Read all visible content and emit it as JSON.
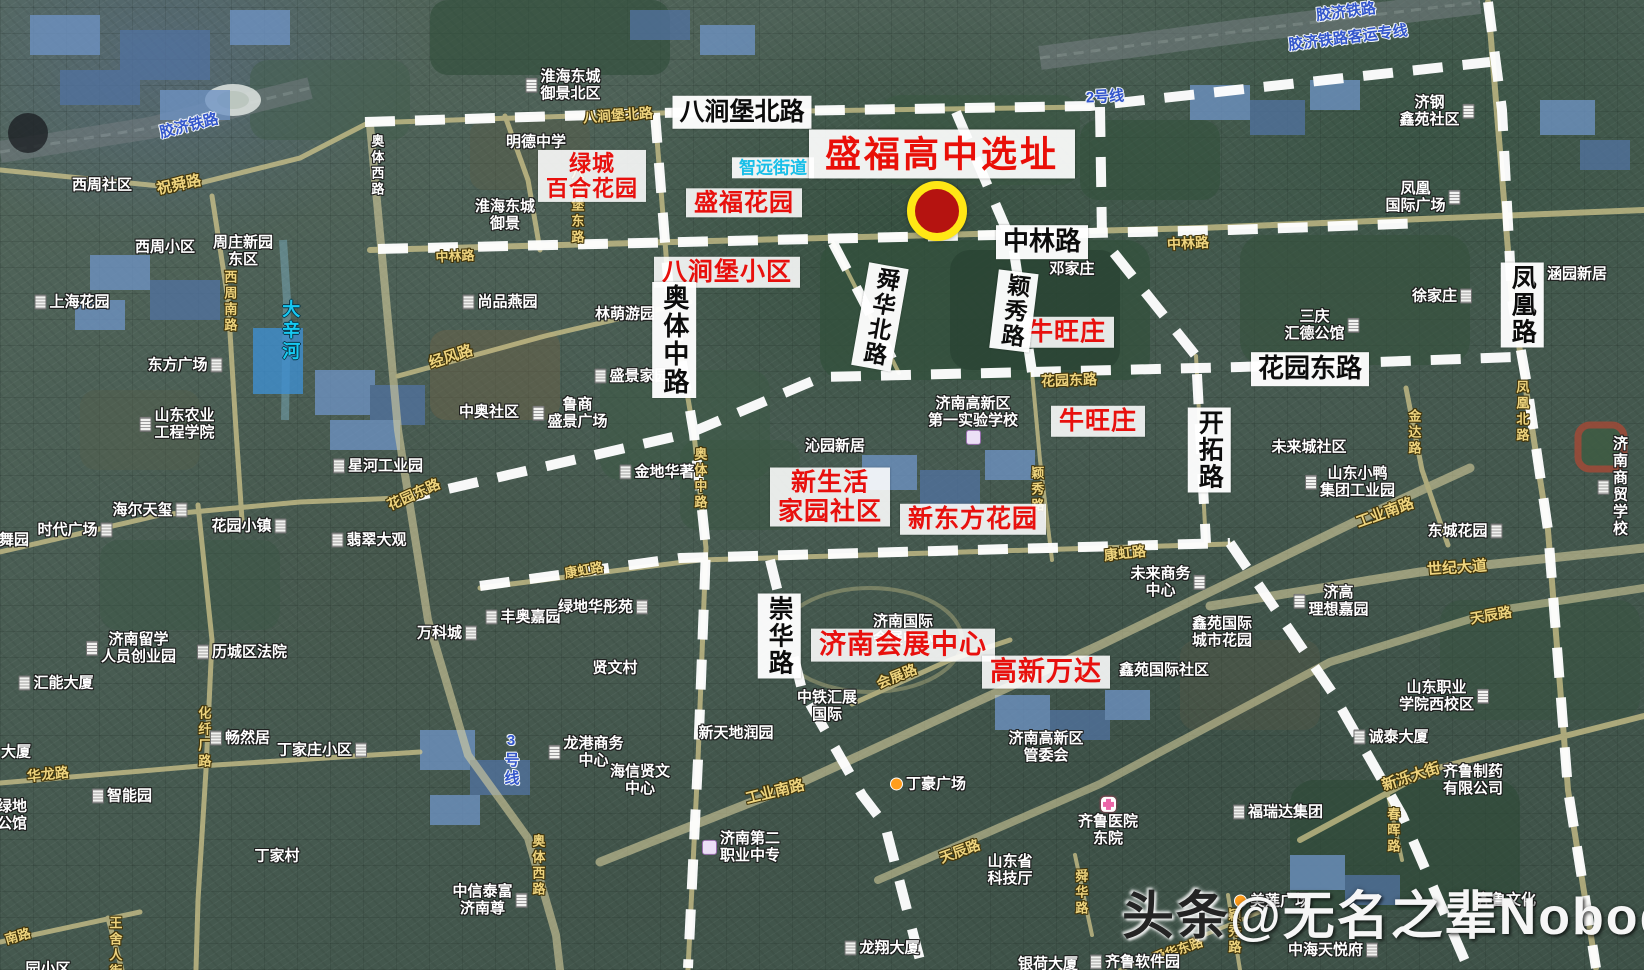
{
  "map": {
    "type": "satellite-annotated",
    "subject": "盛福高中选址",
    "city_area": "济南高新区 / 历城区",
    "accent_red": "#e8100d",
    "road_dash_color": "#ffffff",
    "road_fill_color": "#d7cb8e"
  },
  "marker": {
    "x": 937,
    "y": 211,
    "core_diameter": 44,
    "ring_width": 8,
    "ring_color": "#ffe715",
    "fill_color": "#b51310"
  },
  "watermark": {
    "x": 1122,
    "y": 874,
    "brand": "头条",
    "handle": "@无名之辈Nobody"
  },
  "labels": [
    {
      "t": "盛福高中选址",
      "x": 942,
      "y": 154,
      "k": "title",
      "name": "site-title"
    },
    {
      "t": "绿城\n百合花园",
      "x": 592,
      "y": 176,
      "k": "red",
      "fs": 22
    },
    {
      "t": "盛福花园",
      "x": 744,
      "y": 203,
      "k": "red",
      "fs": 24
    },
    {
      "t": "八涧堡小区",
      "x": 727,
      "y": 272,
      "k": "red",
      "fs": 25
    },
    {
      "t": "牛旺庄",
      "x": 1067,
      "y": 332,
      "k": "red",
      "fs": 25
    },
    {
      "t": "牛旺庄",
      "x": 1098,
      "y": 421,
      "k": "red",
      "fs": 25
    },
    {
      "t": "新生活\n家园社区",
      "x": 830,
      "y": 497,
      "k": "red",
      "fs": 25
    },
    {
      "t": "新东方花园",
      "x": 973,
      "y": 519,
      "k": "red",
      "fs": 25
    },
    {
      "t": "济南会展中心",
      "x": 903,
      "y": 645,
      "k": "red",
      "fs": 27
    },
    {
      "t": "高新万达",
      "x": 1046,
      "y": 672,
      "k": "red",
      "fs": 27
    },
    {
      "t": "八涧堡北路",
      "x": 742,
      "y": 112,
      "k": "roadbig",
      "fs": 25
    },
    {
      "t": "中林路",
      "x": 1042,
      "y": 242,
      "k": "roadbig",
      "fs": 26
    },
    {
      "t": "花园东路",
      "x": 1310,
      "y": 369,
      "k": "roadbig",
      "fs": 26
    },
    {
      "t": "奥体中路",
      "x": 674,
      "y": 340,
      "k": "roadbig",
      "v": 1,
      "fs": 26
    },
    {
      "t": "舜华北路",
      "x": 880,
      "y": 317,
      "k": "roadbig",
      "v": 1,
      "fs": 23,
      "r": 10
    },
    {
      "t": "颖秀路",
      "x": 1014,
      "y": 311,
      "k": "roadbig",
      "v": 1,
      "fs": 23,
      "r": 7
    },
    {
      "t": "开拓路",
      "x": 1209,
      "y": 450,
      "k": "roadbig",
      "v": 1,
      "fs": 25
    },
    {
      "t": "崇华路",
      "x": 779,
      "y": 636,
      "k": "roadbig",
      "v": 1,
      "fs": 25
    },
    {
      "t": "凤凰路",
      "x": 1522,
      "y": 305,
      "k": "roadbig",
      "v": 1,
      "fs": 25
    },
    {
      "t": "胶济铁路",
      "x": 189,
      "y": 126,
      "k": "rail",
      "r": -14
    },
    {
      "t": "胶济铁路",
      "x": 1346,
      "y": 12,
      "k": "rail",
      "r": -7
    },
    {
      "t": "胶济铁路客运专线",
      "x": 1348,
      "y": 38,
      "k": "rail",
      "r": -7
    },
    {
      "t": "2号线",
      "x": 1105,
      "y": 97,
      "k": "rail",
      "r": -3
    },
    {
      "t": "3号线",
      "x": 511,
      "y": 760,
      "k": "rail",
      "v": 1
    },
    {
      "t": "大辛河",
      "x": 290,
      "y": 331,
      "k": "river",
      "v": 1
    },
    {
      "t": "智远街道",
      "x": 773,
      "y": 168,
      "k": "cyanpanel"
    },
    {
      "t": "祝舜路",
      "x": 179,
      "y": 185,
      "k": "ry",
      "r": -12,
      "fs": 15
    },
    {
      "t": "八涧堡北路",
      "x": 618,
      "y": 116,
      "k": "ry",
      "r": -4,
      "fs": 14
    },
    {
      "t": "中林路",
      "x": 455,
      "y": 257,
      "k": "ry",
      "r": -3,
      "fs": 13
    },
    {
      "t": "中林路",
      "x": 1188,
      "y": 244,
      "k": "ry",
      "r": -3,
      "fs": 14
    },
    {
      "t": "八涧堡东路",
      "x": 576,
      "y": 206,
      "k": "ry",
      "v": 1,
      "fs": 13
    },
    {
      "t": "西周南路",
      "x": 229,
      "y": 302,
      "k": "ry",
      "v": 1,
      "fs": 13
    },
    {
      "t": "经风路",
      "x": 451,
      "y": 357,
      "k": "ry",
      "r": -18,
      "fs": 15
    },
    {
      "t": "花园东路",
      "x": 1069,
      "y": 381,
      "k": "ry",
      "r": -2,
      "fs": 14
    },
    {
      "t": "花园东路",
      "x": 414,
      "y": 495,
      "k": "ry",
      "r": -24,
      "fs": 14
    },
    {
      "t": "奥体中路",
      "x": 699,
      "y": 479,
      "k": "ry",
      "v": 1,
      "fs": 13
    },
    {
      "t": "颖秀路",
      "x": 1036,
      "y": 490,
      "k": "ry",
      "v": 1,
      "fs": 13
    },
    {
      "t": "金达路",
      "x": 1413,
      "y": 433,
      "k": "ry",
      "v": 1,
      "fs": 13
    },
    {
      "t": "凤凰北路",
      "x": 1521,
      "y": 412,
      "k": "ry",
      "v": 1,
      "fs": 13
    },
    {
      "t": "工业南路",
      "x": 1385,
      "y": 513,
      "k": "ry",
      "r": -20,
      "fs": 15
    },
    {
      "t": "工业南路",
      "x": 775,
      "y": 792,
      "k": "ry",
      "r": -14,
      "fs": 15
    },
    {
      "t": "世纪大道",
      "x": 1457,
      "y": 568,
      "k": "ry",
      "r": -4,
      "fs": 15
    },
    {
      "t": "康虹路",
      "x": 1125,
      "y": 554,
      "k": "ry",
      "r": -6,
      "fs": 14
    },
    {
      "t": "康虹路",
      "x": 584,
      "y": 571,
      "k": "ry",
      "r": -10,
      "fs": 13
    },
    {
      "t": "天辰路",
      "x": 1491,
      "y": 616,
      "k": "ry",
      "r": -10,
      "fs": 14
    },
    {
      "t": "天辰路",
      "x": 960,
      "y": 852,
      "k": "ry",
      "r": -20,
      "fs": 14
    },
    {
      "t": "新泺大街",
      "x": 1411,
      "y": 777,
      "k": "ry",
      "r": -18,
      "fs": 15
    },
    {
      "t": "会展路",
      "x": 897,
      "y": 677,
      "k": "ry",
      "r": -22,
      "fs": 14
    },
    {
      "t": "化纤厂路",
      "x": 203,
      "y": 738,
      "k": "ry",
      "v": 1,
      "fs": 13
    },
    {
      "t": "华龙路",
      "x": 48,
      "y": 775,
      "k": "ry",
      "r": -6,
      "fs": 14
    },
    {
      "t": "奥体西路",
      "x": 537,
      "y": 866,
      "k": "ry",
      "v": 1,
      "fs": 13
    },
    {
      "t": "舜华路",
      "x": 1080,
      "y": 893,
      "k": "ry",
      "v": 1,
      "fs": 13
    },
    {
      "t": "颖秀路",
      "x": 1233,
      "y": 932,
      "k": "ry",
      "v": 1,
      "fs": 13
    },
    {
      "t": "舜华东路",
      "x": 1178,
      "y": 951,
      "k": "ry",
      "r": -20,
      "fs": 13
    },
    {
      "t": "春晖路",
      "x": 1392,
      "y": 831,
      "k": "ry",
      "v": 1,
      "fs": 13
    },
    {
      "t": "王舍人街",
      "x": 114,
      "y": 948,
      "k": "ry",
      "v": 1,
      "fs": 13
    },
    {
      "t": "南路",
      "x": 18,
      "y": 937,
      "k": "ry",
      "r": -16,
      "fs": 13
    },
    {
      "t": "济南国际\n会展中心",
      "x": 903,
      "y": 630,
      "k": "pl"
    },
    {
      "t": "西周社区",
      "x": 102,
      "y": 185,
      "k": "pl"
    },
    {
      "t": "奥体西路",
      "x": 376,
      "y": 166,
      "k": "pl",
      "v": 1,
      "fs": 13
    },
    {
      "t": "西周小区",
      "x": 165,
      "y": 247,
      "k": "pl"
    },
    {
      "t": "周庄新园\n东区",
      "x": 243,
      "y": 251,
      "k": "pl"
    },
    {
      "t": "上海花园",
      "x": 72,
      "y": 302,
      "k": "pl",
      "ic": "bldg",
      "ip": "l"
    },
    {
      "t": "东方广场",
      "x": 185,
      "y": 365,
      "k": "pl",
      "ic": "bldg",
      "ip": "r"
    },
    {
      "t": "山东农业\n工程学院",
      "x": 177,
      "y": 424,
      "k": "pl",
      "ic": "bldg",
      "ip": "l"
    },
    {
      "t": "星河工业园",
      "x": 378,
      "y": 466,
      "k": "pl",
      "ic": "bldg",
      "ip": "l"
    },
    {
      "t": "海尔天玺",
      "x": 150,
      "y": 510,
      "k": "pl",
      "ic": "bldg",
      "ip": "r"
    },
    {
      "t": "时代广场",
      "x": 75,
      "y": 530,
      "k": "pl",
      "ic": "bldg",
      "ip": "r"
    },
    {
      "t": "花园小镇",
      "x": 249,
      "y": 526,
      "k": "pl",
      "ic": "bldg",
      "ip": "r"
    },
    {
      "t": "翡翠大观",
      "x": 369,
      "y": 540,
      "k": "pl",
      "ic": "bldg",
      "ip": "l"
    },
    {
      "t": "舞园",
      "x": 14,
      "y": 540,
      "k": "pl"
    },
    {
      "t": "济南留学\n人员创业园",
      "x": 131,
      "y": 648,
      "k": "pl",
      "ic": "bldg",
      "ip": "l"
    },
    {
      "t": "历城区法院",
      "x": 242,
      "y": 652,
      "k": "pl",
      "ic": "bldg",
      "ip": "l"
    },
    {
      "t": "汇能大厦",
      "x": 56,
      "y": 683,
      "k": "pl",
      "ic": "bldg",
      "ip": "l"
    },
    {
      "t": "大厦",
      "x": 16,
      "y": 752,
      "k": "pl"
    },
    {
      "t": "智能园",
      "x": 122,
      "y": 796,
      "k": "pl",
      "ic": "bldg",
      "ip": "l"
    },
    {
      "t": "畅然居",
      "x": 240,
      "y": 738,
      "k": "pl",
      "ic": "bldg",
      "ip": "l"
    },
    {
      "t": "丁家庄小区",
      "x": 322,
      "y": 750,
      "k": "pl",
      "ic": "bldg",
      "ip": "r"
    },
    {
      "t": "丁家村",
      "x": 277,
      "y": 856,
      "k": "pl"
    },
    {
      "t": "绿地\n公馆",
      "x": 12,
      "y": 815,
      "k": "pl"
    },
    {
      "t": "淮海东城\n御景北区",
      "x": 563,
      "y": 85,
      "k": "pl",
      "ic": "bldg",
      "ip": "l"
    },
    {
      "t": "明德中学",
      "x": 536,
      "y": 142,
      "k": "pl"
    },
    {
      "t": "淮海东城\n御景",
      "x": 505,
      "y": 215,
      "k": "pl"
    },
    {
      "t": "尚品燕园",
      "x": 500,
      "y": 302,
      "k": "pl",
      "ic": "bldg",
      "ip": "l"
    },
    {
      "t": "林萌游园",
      "x": 625,
      "y": 314,
      "k": "pl"
    },
    {
      "t": "盛景家园",
      "x": 632,
      "y": 376,
      "k": "pl",
      "ic": "bldg",
      "ip": "l"
    },
    {
      "t": "中奥社区",
      "x": 489,
      "y": 412,
      "k": "pl"
    },
    {
      "t": "鲁商\n盛景广场",
      "x": 570,
      "y": 413,
      "k": "pl",
      "ic": "bldg",
      "ip": "l"
    },
    {
      "t": "金地华著",
      "x": 657,
      "y": 472,
      "k": "pl",
      "ic": "bldg",
      "ip": "l"
    },
    {
      "t": "万科城",
      "x": 447,
      "y": 633,
      "k": "pl",
      "ic": "bldg",
      "ip": "r"
    },
    {
      "t": "丰奥嘉园",
      "x": 523,
      "y": 617,
      "k": "pl",
      "ic": "bldg",
      "ip": "l"
    },
    {
      "t": "绿地华彤苑",
      "x": 603,
      "y": 607,
      "k": "pl",
      "ic": "bldg",
      "ip": "r"
    },
    {
      "t": "贤文村",
      "x": 615,
      "y": 668,
      "k": "pl"
    },
    {
      "t": "龙港商务\n中心",
      "x": 586,
      "y": 752,
      "k": "pl",
      "ic": "bldg",
      "ip": "l"
    },
    {
      "t": "海信贤文\n中心",
      "x": 640,
      "y": 780,
      "k": "pl"
    },
    {
      "t": "新天地润园",
      "x": 736,
      "y": 733,
      "k": "pl"
    },
    {
      "t": "中铁汇展\n国际",
      "x": 827,
      "y": 706,
      "k": "pl"
    },
    {
      "t": "丁豪广场",
      "x": 928,
      "y": 784,
      "k": "pl",
      "ic": "dot",
      "ip": "l"
    },
    {
      "t": "济南高新区\n管委会",
      "x": 1046,
      "y": 747,
      "k": "pl"
    },
    {
      "t": "济南第二\n职业中专",
      "x": 741,
      "y": 847,
      "k": "pl",
      "ic": "school",
      "ip": "l"
    },
    {
      "t": "中信泰富\n济南尊",
      "x": 490,
      "y": 900,
      "k": "pl",
      "ic": "bldg",
      "ip": "r"
    },
    {
      "t": "邓家庄",
      "x": 1072,
      "y": 269,
      "k": "pl"
    },
    {
      "t": "济南高新区\n第一实验学校",
      "x": 973,
      "y": 420,
      "k": "pl",
      "ic": "school",
      "ip": "b"
    },
    {
      "t": "沁园新居",
      "x": 835,
      "y": 446,
      "k": "pl"
    },
    {
      "t": "未来商务\n中心",
      "x": 1168,
      "y": 582,
      "k": "pl",
      "ic": "bldg",
      "ip": "r"
    },
    {
      "t": "鑫苑国际\n城市花园",
      "x": 1222,
      "y": 632,
      "k": "pl"
    },
    {
      "t": "鑫苑国际社区",
      "x": 1164,
      "y": 670,
      "k": "pl"
    },
    {
      "t": "未来城社区",
      "x": 1309,
      "y": 447,
      "k": "pl"
    },
    {
      "t": "山东小鸭\n集团工业园",
      "x": 1350,
      "y": 482,
      "k": "pl",
      "ic": "bldg",
      "ip": "l"
    },
    {
      "t": "三庆\n汇德公馆",
      "x": 1322,
      "y": 325,
      "k": "pl",
      "ic": "bldg",
      "ip": "r"
    },
    {
      "t": "徐家庄",
      "x": 1442,
      "y": 296,
      "k": "pl",
      "ic": "bldg",
      "ip": "r"
    },
    {
      "t": "济钢\n鑫苑社区",
      "x": 1437,
      "y": 111,
      "k": "pl",
      "ic": "bldg",
      "ip": "r"
    },
    {
      "t": "凤凰\n国际广场",
      "x": 1423,
      "y": 197,
      "k": "pl",
      "ic": "bldg",
      "ip": "r"
    },
    {
      "t": "涵园新居",
      "x": 1577,
      "y": 274,
      "k": "pl"
    },
    {
      "t": "东城花园",
      "x": 1465,
      "y": 531,
      "k": "pl",
      "ic": "bldg",
      "ip": "r"
    },
    {
      "t": "济南商贸\n学校",
      "x": 1613,
      "y": 487,
      "k": "pl",
      "ic": "bldg",
      "ip": "l"
    },
    {
      "t": "济高\n理想嘉园",
      "x": 1331,
      "y": 601,
      "k": "pl",
      "ic": "bldg",
      "ip": "l"
    },
    {
      "t": "山东职业\n学院西校区",
      "x": 1444,
      "y": 696,
      "k": "pl",
      "ic": "bldg",
      "ip": "r"
    },
    {
      "t": "诚泰大厦",
      "x": 1391,
      "y": 737,
      "k": "pl",
      "ic": "bldg",
      "ip": "l"
    },
    {
      "t": "齐鲁制药\n有限公司",
      "x": 1473,
      "y": 780,
      "k": "pl"
    },
    {
      "t": "福瑞达集团",
      "x": 1278,
      "y": 812,
      "k": "pl",
      "ic": "bldg",
      "ip": "l"
    },
    {
      "t": "齐鲁医院\n东院",
      "x": 1108,
      "y": 822,
      "k": "pl",
      "ic": "cross",
      "ip": "t"
    },
    {
      "t": "山东省\n科技厅",
      "x": 1010,
      "y": 870,
      "k": "pl"
    },
    {
      "t": "龙翔大厦",
      "x": 882,
      "y": 948,
      "k": "pl",
      "ic": "bldg",
      "ip": "l"
    },
    {
      "t": "银荷大厦",
      "x": 1048,
      "y": 964,
      "k": "pl"
    },
    {
      "t": "齐鲁软件园",
      "x": 1135,
      "y": 962,
      "k": "pl",
      "ic": "bldg",
      "ip": "l"
    },
    {
      "t": "齐鲁文化",
      "x": 1506,
      "y": 900,
      "k": "pl"
    },
    {
      "t": "中海天悦府",
      "x": 1333,
      "y": 950,
      "k": "pl",
      "ic": "bldg",
      "ip": "r"
    },
    {
      "t": "美莲广场",
      "x": 1272,
      "y": 901,
      "k": "pl",
      "ic": "dot",
      "ip": "l"
    },
    {
      "t": "园小区",
      "x": 48,
      "y": 969,
      "k": "pl"
    }
  ]
}
